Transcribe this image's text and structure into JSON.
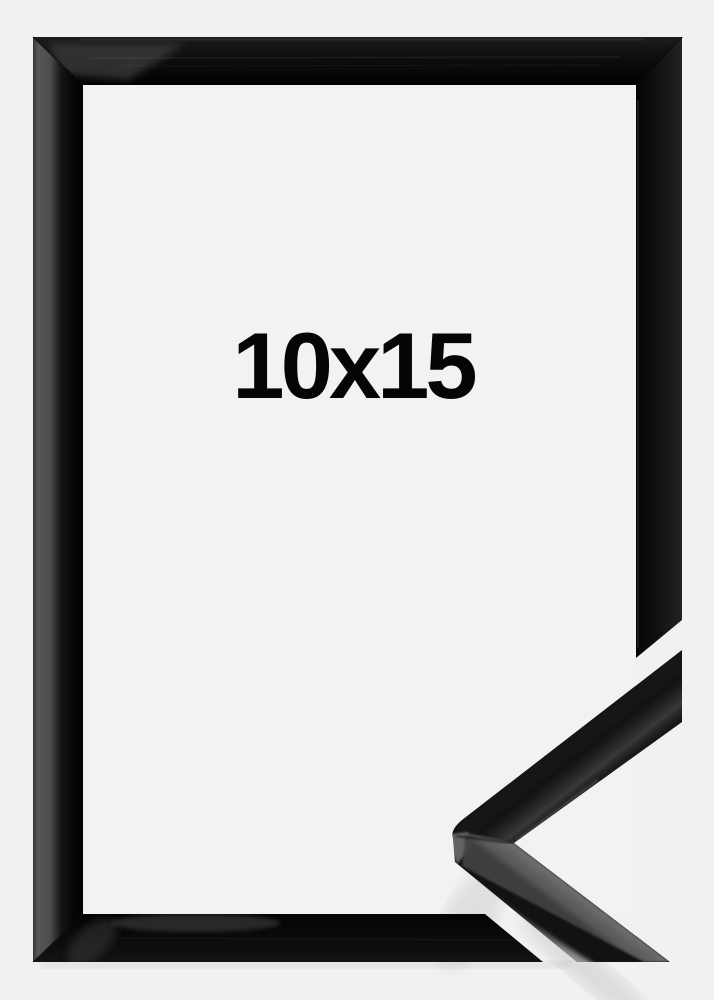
{
  "product": {
    "size_label": "10x15",
    "colors": {
      "background": "#f1f1f2",
      "frame_black": "#0d0d0d",
      "profile_side_gray": "#6a6a6a",
      "specular_highlight": "#c6c6c6",
      "label_text": "#050505"
    }
  }
}
